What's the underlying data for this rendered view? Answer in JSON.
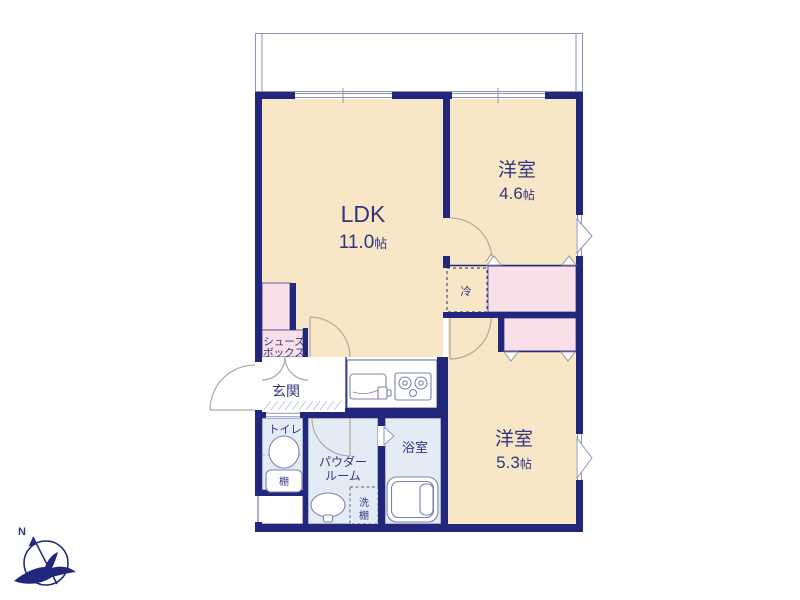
{
  "floorplan": {
    "rooms": {
      "ldk": {
        "name": "LDK",
        "area": "11.0",
        "unit": "帖"
      },
      "bedroom1": {
        "name": "洋室",
        "area": "4.6",
        "unit": "帖"
      },
      "bedroom2": {
        "name": "洋室",
        "area": "5.3",
        "unit": "帖"
      },
      "entrance": {
        "name": "玄関"
      },
      "toilet": {
        "name": "トイレ",
        "shelf": "棚"
      },
      "powder_room": {
        "name_line1": "パウダー",
        "name_line2": "ルーム"
      },
      "wash_shelf": {
        "char1": "洗",
        "char2": "棚"
      },
      "bathroom": {
        "name": "浴室"
      },
      "shoe_box": {
        "name_line1": "シューズ",
        "name_line2": "ボックス"
      },
      "refrigerator": {
        "name": "冷"
      }
    },
    "compass": {
      "north_label": "N"
    },
    "colors": {
      "wall": "#23277b",
      "room_cream": "#f8e7c6",
      "closet_pink": "#f9dfe7",
      "wet_area_blue": "#e3ecf4",
      "label_text": "#32367f",
      "door_arc": "#b3aca2"
    }
  }
}
